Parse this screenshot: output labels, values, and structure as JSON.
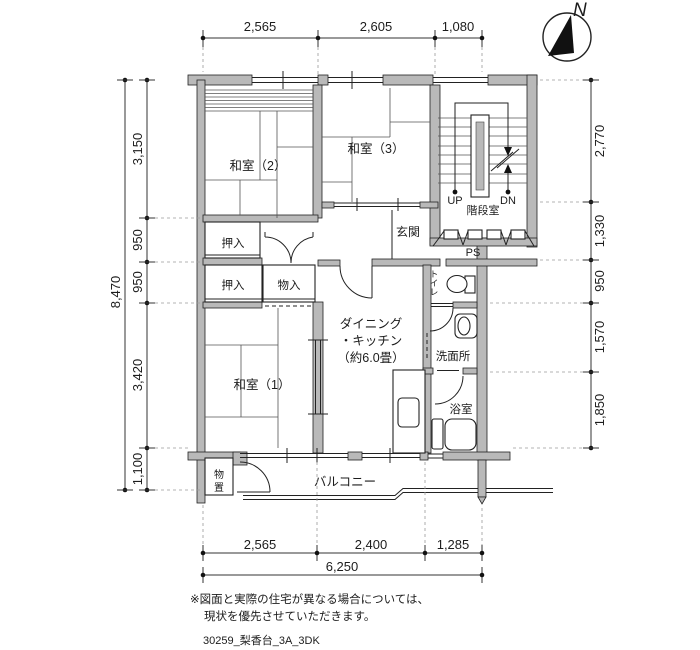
{
  "compass": {
    "north_label": "N"
  },
  "dims": {
    "top": [
      "2,565",
      "2,605",
      "1,080"
    ],
    "left_total": "8,470",
    "left": [
      "3,150",
      "950",
      "950",
      "3,420",
      "1,100"
    ],
    "right": [
      "2,770",
      "1,330",
      "950",
      "1,570",
      "1,850"
    ],
    "bottom": [
      "2,565",
      "2,400",
      "1,285"
    ],
    "bottom_total": "6,250"
  },
  "rooms": {
    "washitsu2": "和室（2）",
    "washitsu3": "和室（3）",
    "washitsu1": "和室（1）",
    "oshiire_upper": "押入",
    "oshiire_lower": "押入",
    "mononyu": "物入",
    "genkan": "玄関",
    "kaidanshitsu": "階段室",
    "ps": "PS",
    "up": "UP",
    "dn": "DN",
    "dk1": "ダイニング",
    "dk2": "・キッチン",
    "dk3": "（約6.0畳）",
    "senmenjo": "洗面所",
    "yokushitsu": "浴室",
    "balcony": "バルコニー",
    "toilet_chars": [
      "ト",
      "イ",
      "レ"
    ],
    "monooki_chars": [
      "物",
      "置"
    ]
  },
  "footer": {
    "note1": "※図面と実際の住宅が異なる場合については、",
    "note2": "現状を優先させていただきます。",
    "drawing_id": "30259_梨香台_3A_3DK"
  }
}
